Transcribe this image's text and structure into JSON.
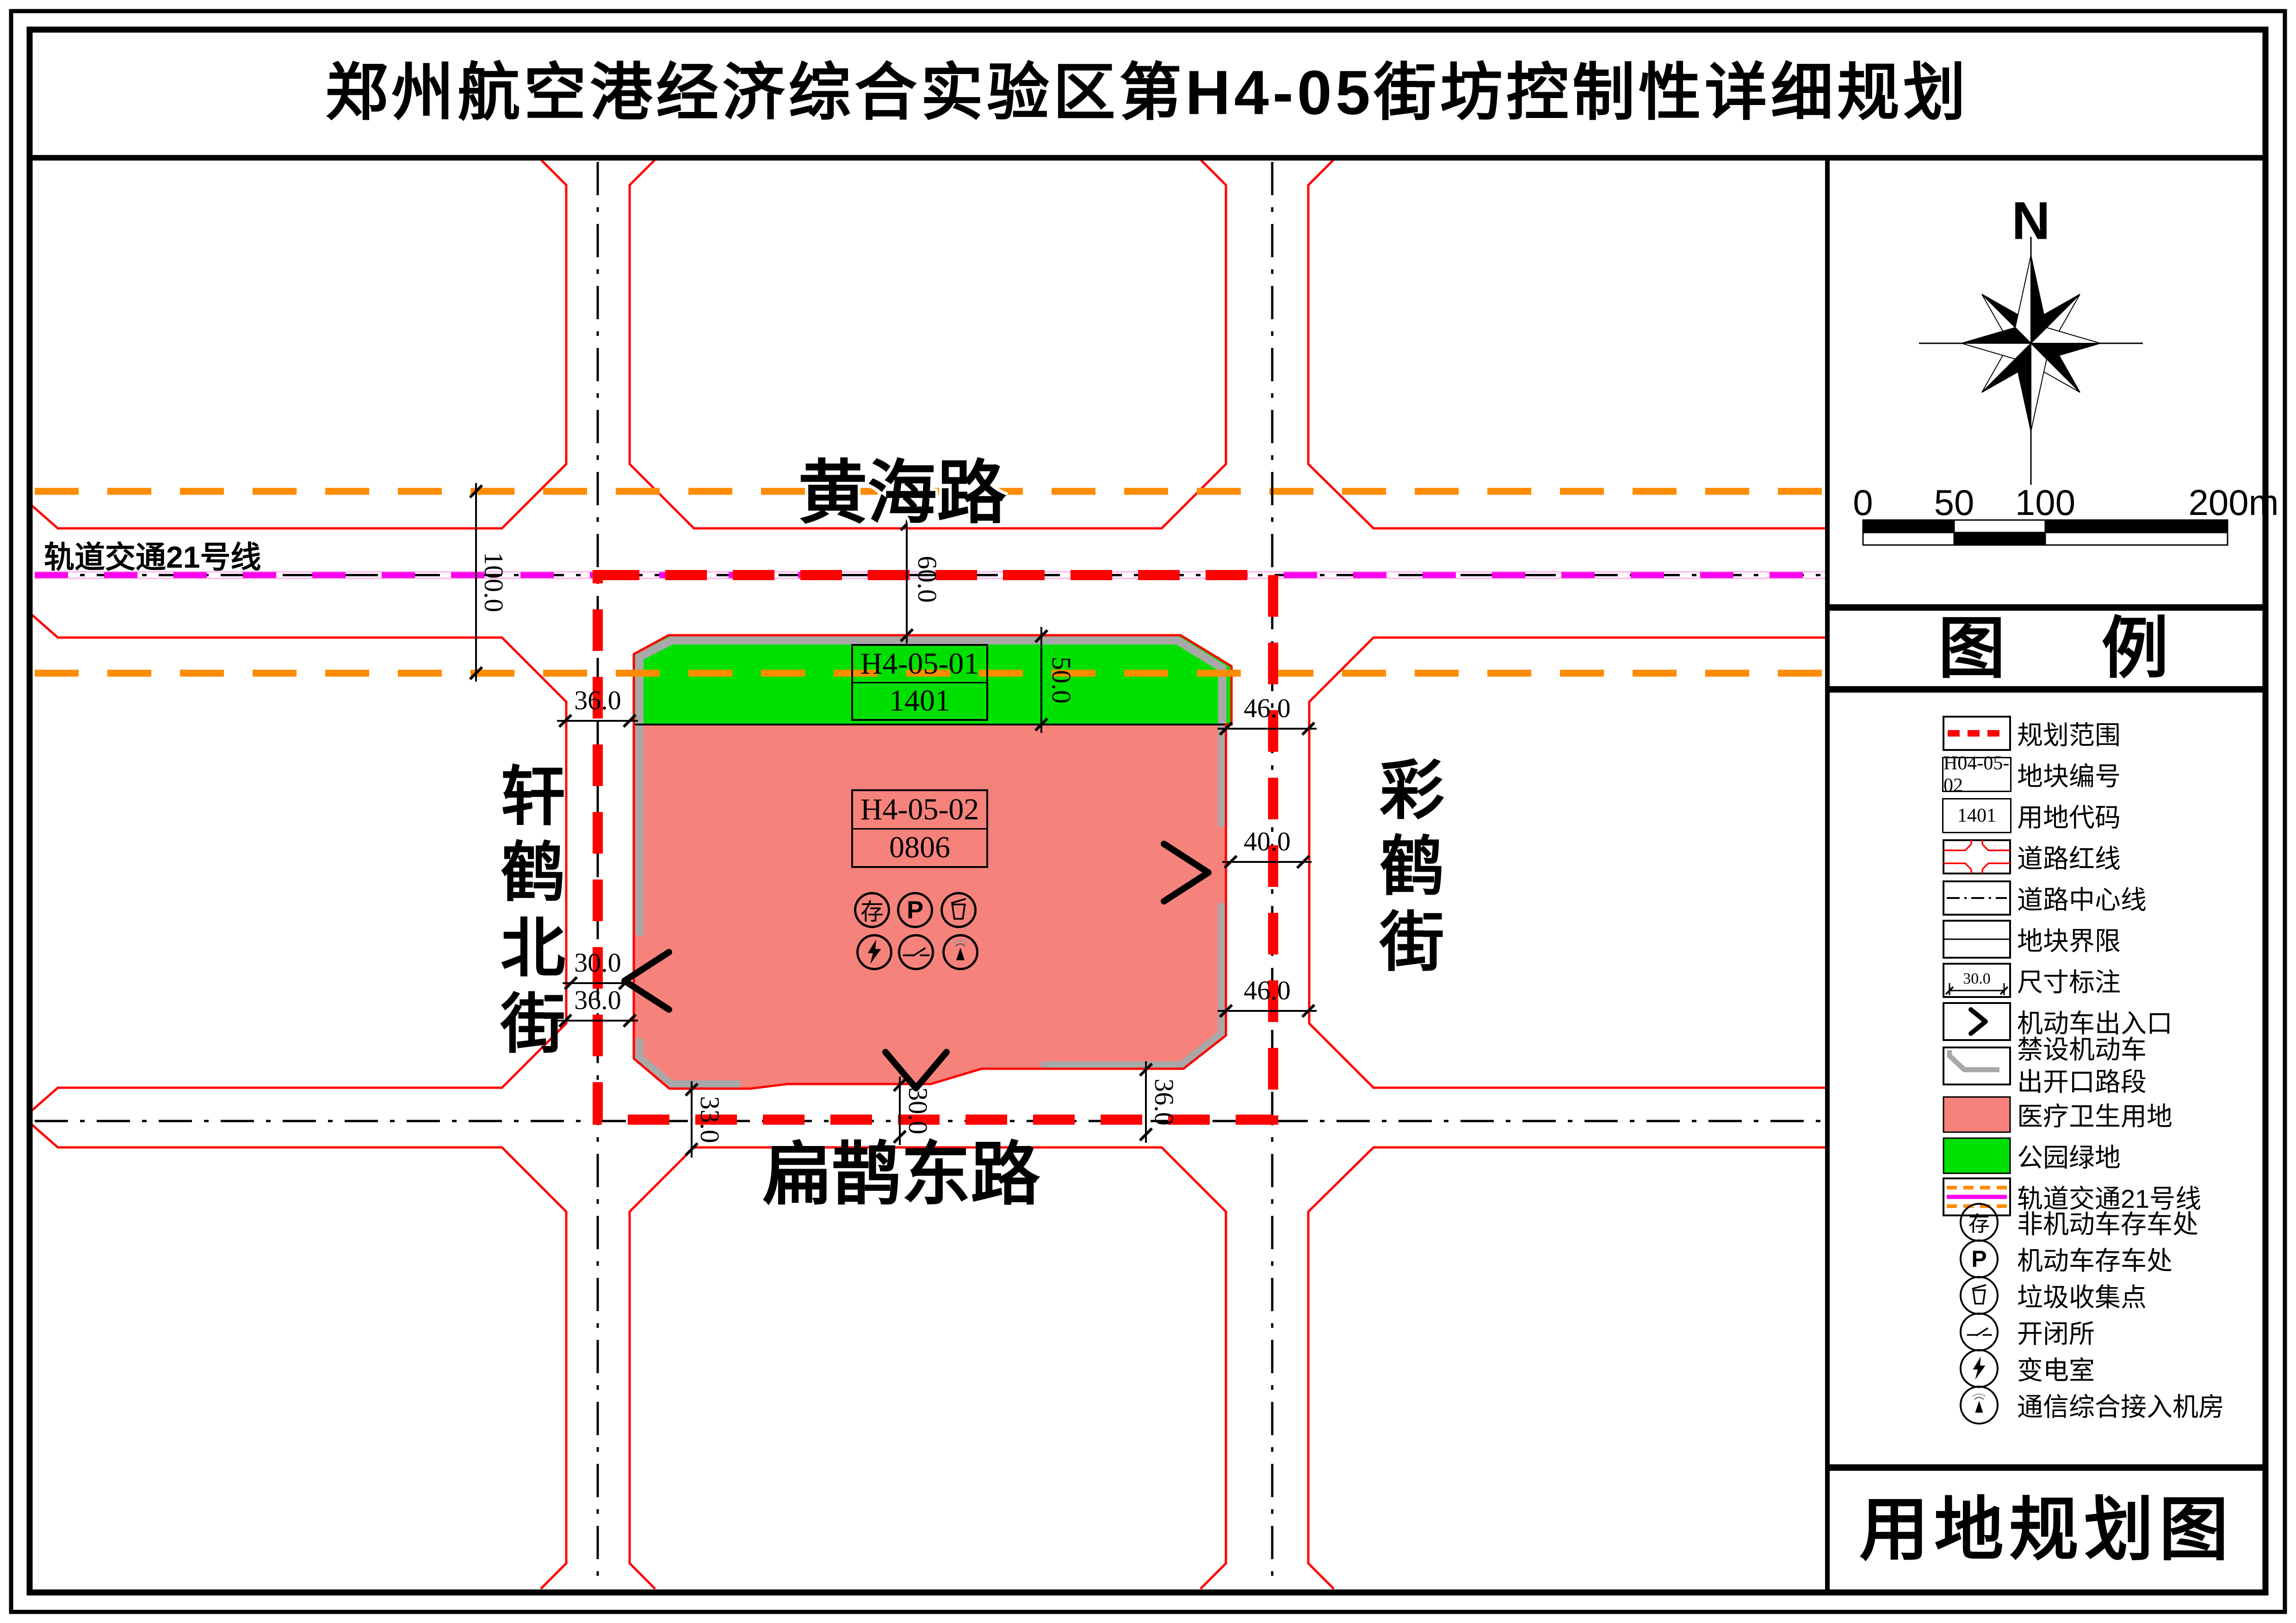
{
  "title": "郑州航空港经济综合实验区第H4-05街坊控制性详细规划",
  "map": {
    "road_names": {
      "north": "黄海路",
      "west": "轩鹤北街",
      "east": "彩鹤街",
      "south": "扁鹊东路"
    },
    "rail_line_label": "轨道交通21号线",
    "parcels": [
      {
        "parcel_code": "H4-05-01",
        "use_code": "1401",
        "use_type": "公园绿地"
      },
      {
        "parcel_code": "H4-05-02",
        "use_code": "0806",
        "use_type": "医疗卫生用地"
      }
    ],
    "facility_glyphs": {
      "bicycle_parking": "存",
      "car_parking": "P"
    },
    "dimensions": {
      "rail_corridor_width": "100.0",
      "huanghai_road_width": "60.0",
      "green_strip_depth": "50.0",
      "west_road_top": "36.0",
      "west_road_mid": "30.0",
      "west_road_bottom": "36.0",
      "east_road_top": "46.0",
      "east_road_mid": "40.0",
      "east_road_bottom": "46.0",
      "south_road_left": "33.0",
      "south_road_mid": "30.0",
      "south_road_right": "36.0"
    },
    "colors": {
      "planning_boundary_red": "#FF0000",
      "rail_magenta": "#FF00EE",
      "rail_corridor_orange": "#FF8C00",
      "park_green": "#00E000",
      "medical_pink": "#F5827B",
      "no_opening_gray": "#A8A8A8"
    }
  },
  "panel": {
    "compass_label": "N",
    "scale_ticks": [
      "0",
      "50",
      "100",
      "200m"
    ],
    "legend_title_left": "图",
    "legend_title_right": "例",
    "footer_title": "用地规划图",
    "legend_items": [
      {
        "label": "规划范围"
      },
      {
        "label": "地块编号",
        "code": "H04-05-02"
      },
      {
        "label": "用地代码",
        "code": "1401"
      },
      {
        "label": "道路红线"
      },
      {
        "label": "道路中心线"
      },
      {
        "label": "地块界限"
      },
      {
        "label": "尺寸标注",
        "code": "30.0"
      },
      {
        "label": "机动车出入口"
      },
      {
        "label": "禁设机动车",
        "label2": "出开口路段"
      },
      {
        "label": "医疗卫生用地"
      },
      {
        "label": "公园绿地"
      },
      {
        "label": "轨道交通21号线"
      },
      {
        "label": "非机动车存车处",
        "glyph": "存"
      },
      {
        "label": "机动车存车处",
        "glyph": "P"
      },
      {
        "label": "垃圾收集点"
      },
      {
        "label": "开闭所"
      },
      {
        "label": "变电室"
      },
      {
        "label": "通信综合接入机房"
      }
    ]
  }
}
